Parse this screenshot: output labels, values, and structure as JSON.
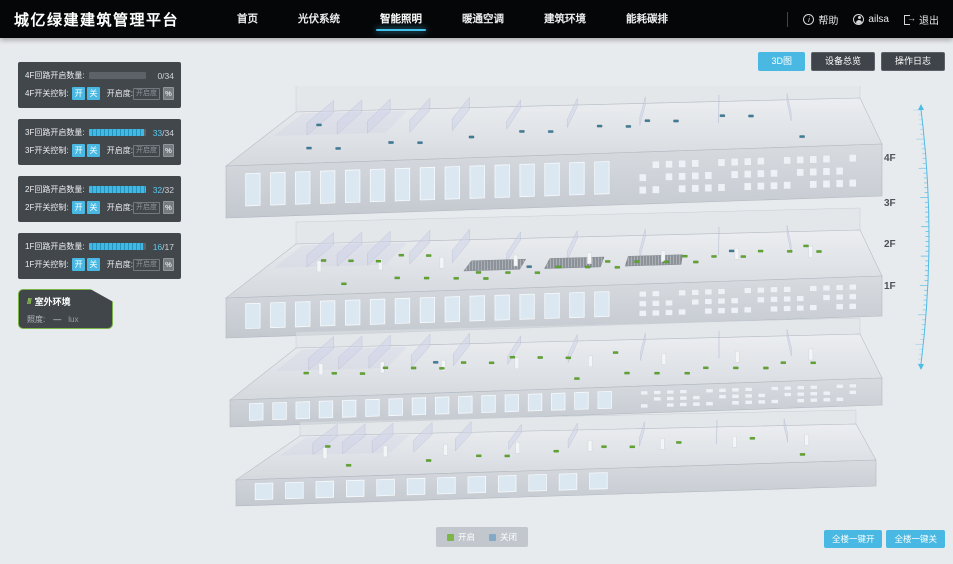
{
  "header": {
    "title": "城亿绿建建筑管理平台",
    "nav": [
      {
        "label": "首页",
        "active": false
      },
      {
        "label": "光伏系统",
        "active": false
      },
      {
        "label": "智能照明",
        "active": true
      },
      {
        "label": "暖通空调",
        "active": false
      },
      {
        "label": "建筑环境",
        "active": false
      },
      {
        "label": "能耗碳排",
        "active": false
      }
    ],
    "help_label": "帮助",
    "user_name": "ailsa",
    "logout_label": "退出"
  },
  "toolbar": {
    "view_3d_label": "3D图",
    "device_overview_label": "设备总览",
    "operation_log_label": "操作日志"
  },
  "floor_panels": [
    {
      "floor": "4F",
      "circuit_label": "4F回路开启数量:",
      "on": 0,
      "total": 34,
      "on_display": "0",
      "total_display": "/34",
      "switch_label": "4F开关控制:",
      "on_btn": "开",
      "off_btn": "关",
      "dim_label": "开启度:",
      "dim_placeholder": "开启度",
      "percent_label": "%"
    },
    {
      "floor": "3F",
      "circuit_label": "3F回路开启数量:",
      "on": 33,
      "total": 34,
      "on_display": "33",
      "total_display": "/34",
      "switch_label": "3F开关控制:",
      "on_btn": "开",
      "off_btn": "关",
      "dim_label": "开启度:",
      "dim_placeholder": "开启度",
      "percent_label": "%"
    },
    {
      "floor": "2F",
      "circuit_label": "2F回路开启数量:",
      "on": 32,
      "total": 32,
      "on_display": "32",
      "total_display": "/32",
      "switch_label": "2F开关控制:",
      "on_btn": "开",
      "off_btn": "关",
      "dim_label": "开启度:",
      "dim_placeholder": "开启度",
      "percent_label": "%"
    },
    {
      "floor": "1F",
      "circuit_label": "1F回路开启数量:",
      "on": 16,
      "total": 17,
      "on_display": "16",
      "total_display": "/17",
      "switch_label": "1F开关控制:",
      "on_btn": "开",
      "off_btn": "关",
      "dim_label": "开启度:",
      "dim_placeholder": "开启度",
      "percent_label": "%"
    }
  ],
  "outdoor": {
    "title": "室外环境",
    "metric_label": "照度:",
    "metric_value": "—",
    "metric_unit": "lux"
  },
  "floor_markers": [
    "4F",
    "3F",
    "2F",
    "1F"
  ],
  "legend": {
    "on_label": "开启",
    "off_label": "关闭"
  },
  "bottom_actions": {
    "all_on_label": "全楼一键开",
    "all_off_label": "全楼一键关"
  },
  "building": {
    "floors": [
      {
        "name": "4F",
        "lights_on": 0,
        "lights_off": 15
      },
      {
        "name": "3F",
        "lights_on": 27,
        "lights_off": 2
      },
      {
        "name": "2F",
        "lights_on": 21,
        "lights_off": 1
      },
      {
        "name": "1F",
        "lights_on": 11,
        "lights_off": 0
      }
    ]
  },
  "colors": {
    "accent": "#49b8e2",
    "progress_fill": "#45b8e2",
    "light_on": "#5ea62d",
    "light_off": "#3e7c97",
    "legend_on": "#7cb648",
    "legend_off": "#84a9c6"
  }
}
